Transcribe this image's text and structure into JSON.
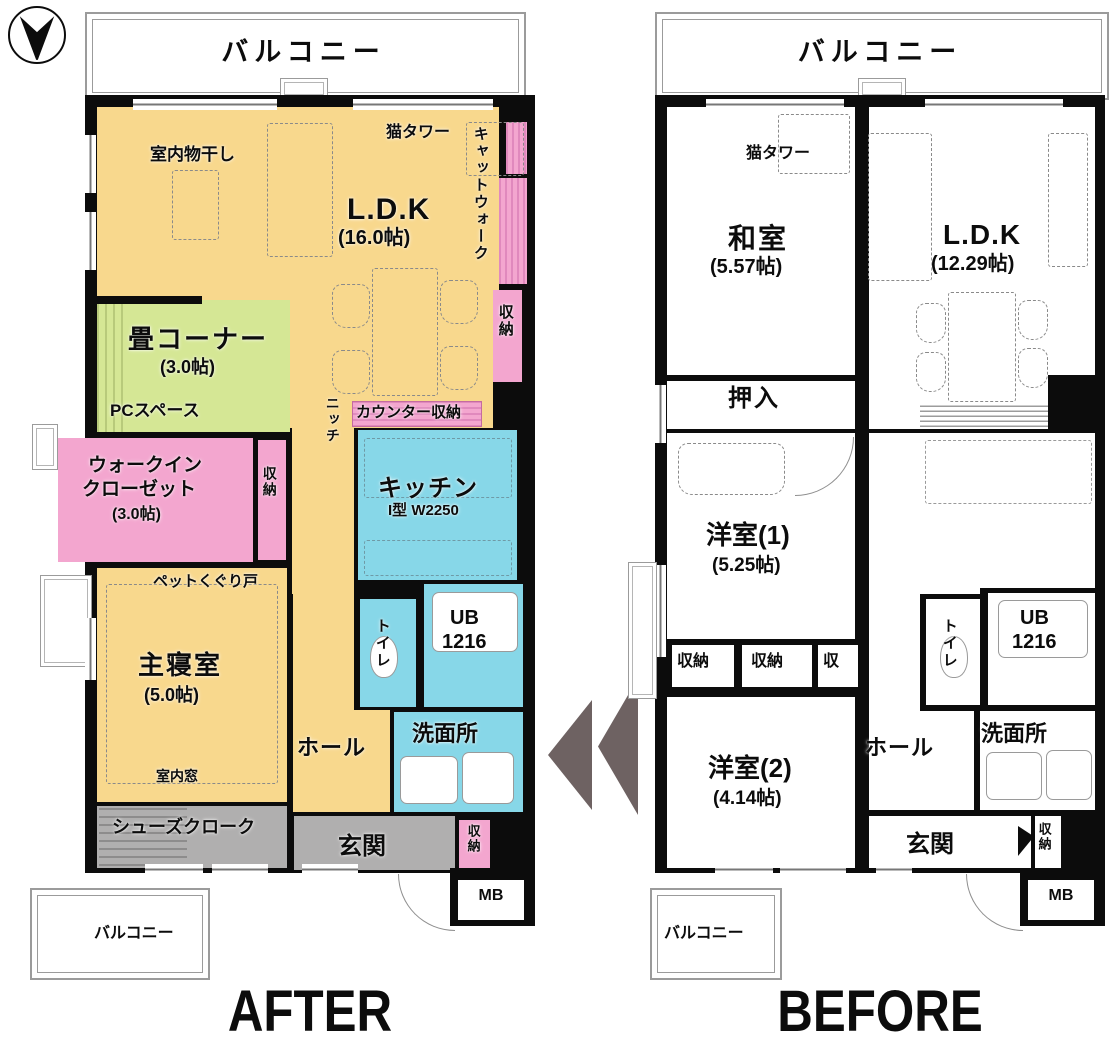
{
  "meta": {
    "after_title": "AFTER",
    "before_title": "BEFORE"
  },
  "colors": {
    "room_yellow": "#F8D88D",
    "room_green": "#D5E795",
    "room_pink": "#F3A6CF",
    "room_blue": "#87D7E8",
    "room_gray": "#B0AFAF",
    "wall_black": "#0C0C0C",
    "arrow_gray": "#6E6262"
  },
  "after": {
    "balcony_top": "バルコニー",
    "balcony_bottom": "バルコニー",
    "laundry": "室内物干し",
    "cat_tower": "猫タワー",
    "catwalk": "キャットウォーク",
    "ldk_name": "L.D.K",
    "ldk_size": "(16.0帖)",
    "storage": "収納",
    "tatami_name": "畳コーナー",
    "tatami_size": "(3.0帖)",
    "pc_space": "PCスペース",
    "counter_storage": "カウンター収納",
    "niche": "ニッチ",
    "kitchen_name": "キッチン",
    "kitchen_spec": "I型 W2250",
    "wic_line1": "ウォークイン",
    "wic_line2": "クローゼット",
    "wic_size": "(3.0帖)",
    "pet_door": "ペットくぐり戸",
    "bedroom_name": "主寝室",
    "bedroom_size": "(5.0帖)",
    "interior_window": "室内窓",
    "hall": "ホール",
    "toilet": "トイレ",
    "ub_line1": "UB",
    "ub_line2": "1216",
    "washroom": "洗面所",
    "shoes_cloak": "シューズクローク",
    "entrance": "玄関",
    "mb": "MB"
  },
  "before": {
    "balcony_top": "バルコニー",
    "balcony_bottom": "バルコニー",
    "cat_tower": "猫タワー",
    "washitsu_name": "和室",
    "washitsu_size": "(5.57帖)",
    "ldk_name": "L.D.K",
    "ldk_size": "(12.29帖)",
    "oshiire": "押入",
    "yoshitsu1_name": "洋室(1)",
    "yoshitsu1_size": "(5.25帖)",
    "storage": "収納",
    "storage_short": "収",
    "toilet": "トイレ",
    "ub_line1": "UB",
    "ub_line2": "1216",
    "washroom": "洗面所",
    "hall": "ホール",
    "yoshitsu2_name": "洋室(2)",
    "yoshitsu2_size": "(4.14帖)",
    "entrance": "玄関",
    "mb": "MB"
  }
}
